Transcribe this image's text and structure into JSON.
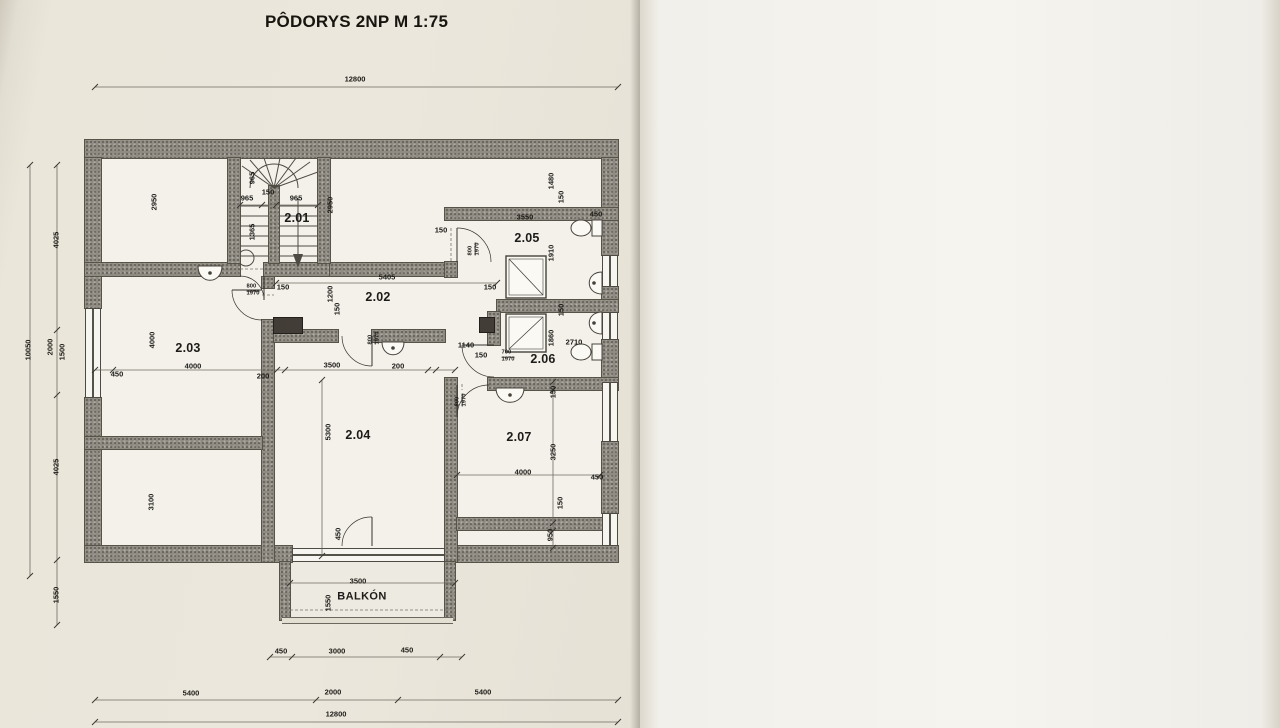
{
  "plan": {
    "title": "PÔDORYS 2NP  M 1:75",
    "labels": [
      {
        "t": "2.01",
        "x": 297,
        "y": 218,
        "c": "room"
      },
      {
        "t": "2.02",
        "x": 378,
        "y": 297,
        "c": "room"
      },
      {
        "t": "2.03",
        "x": 188,
        "y": 348,
        "c": "room"
      },
      {
        "t": "2.04",
        "x": 358,
        "y": 435,
        "c": "room"
      },
      {
        "t": "2.05",
        "x": 527,
        "y": 238,
        "c": "room"
      },
      {
        "t": "2.06",
        "x": 543,
        "y": 359,
        "c": "room"
      },
      {
        "t": "2.07",
        "x": 519,
        "y": 437,
        "c": "room"
      },
      {
        "t": "BALKÓN",
        "x": 362,
        "y": 597,
        "c": "roomname"
      },
      {
        "t": "12800",
        "x": 355,
        "y": 79
      },
      {
        "t": "965",
        "x": 247,
        "y": 198
      },
      {
        "t": "150",
        "x": 268,
        "y": 192
      },
      {
        "t": "965",
        "x": 296,
        "y": 198
      },
      {
        "t": "150",
        "x": 283,
        "y": 287
      },
      {
        "t": "5405",
        "x": 387,
        "y": 277
      },
      {
        "t": "150",
        "x": 441,
        "y": 230
      },
      {
        "t": "3550",
        "x": 525,
        "y": 217
      },
      {
        "t": "450",
        "x": 596,
        "y": 214
      },
      {
        "t": "150",
        "x": 490,
        "y": 287
      },
      {
        "t": "1140",
        "x": 466,
        "y": 345
      },
      {
        "t": "150",
        "x": 481,
        "y": 355
      },
      {
        "t": "2710",
        "x": 574,
        "y": 342
      },
      {
        "t": "450",
        "x": 117,
        "y": 374
      },
      {
        "t": "4000",
        "x": 193,
        "y": 366
      },
      {
        "t": "200",
        "x": 263,
        "y": 376
      },
      {
        "t": "3500",
        "x": 332,
        "y": 365
      },
      {
        "t": "200",
        "x": 398,
        "y": 366
      },
      {
        "t": "4000",
        "x": 523,
        "y": 472
      },
      {
        "t": "450",
        "x": 597,
        "y": 477
      },
      {
        "t": "3500",
        "x": 358,
        "y": 581
      },
      {
        "t": "450",
        "x": 281,
        "y": 651
      },
      {
        "t": "3000",
        "x": 337,
        "y": 651
      },
      {
        "t": "450",
        "x": 407,
        "y": 650
      },
      {
        "t": "5400",
        "x": 191,
        "y": 693
      },
      {
        "t": "2000",
        "x": 333,
        "y": 692
      },
      {
        "t": "5400",
        "x": 483,
        "y": 692
      },
      {
        "t": "12800",
        "x": 336,
        "y": 714
      },
      {
        "t": "10050",
        "x": 28,
        "y": 350,
        "r": 1
      },
      {
        "t": "4025",
        "x": 56,
        "y": 240,
        "r": 1
      },
      {
        "t": "2000",
        "x": 50,
        "y": 347,
        "r": 1
      },
      {
        "t": "1500",
        "x": 62,
        "y": 352,
        "r": 1
      },
      {
        "t": "4025",
        "x": 56,
        "y": 467,
        "r": 1
      },
      {
        "t": "1550",
        "x": 56,
        "y": 595,
        "r": 1
      },
      {
        "t": "2950",
        "x": 154,
        "y": 202,
        "r": 1
      },
      {
        "t": "965",
        "x": 252,
        "y": 178,
        "r": 1
      },
      {
        "t": "1365",
        "x": 252,
        "y": 232,
        "r": 1
      },
      {
        "t": "2950",
        "x": 330,
        "y": 205,
        "r": 1
      },
      {
        "t": "1480",
        "x": 551,
        "y": 181,
        "r": 1
      },
      {
        "t": "150",
        "x": 561,
        "y": 197,
        "r": 1
      },
      {
        "t": "1910",
        "x": 551,
        "y": 253,
        "r": 1
      },
      {
        "t": "150",
        "x": 561,
        "y": 310,
        "r": 1
      },
      {
        "t": "1860",
        "x": 551,
        "y": 338,
        "r": 1
      },
      {
        "t": "1200",
        "x": 330,
        "y": 294,
        "r": 1
      },
      {
        "t": "150",
        "x": 337,
        "y": 309,
        "r": 1
      },
      {
        "t": "4000",
        "x": 152,
        "y": 340,
        "r": 1
      },
      {
        "t": "3100",
        "x": 151,
        "y": 502,
        "r": 1
      },
      {
        "t": "5300",
        "x": 328,
        "y": 432,
        "r": 1
      },
      {
        "t": "450",
        "x": 338,
        "y": 534,
        "r": 1
      },
      {
        "t": "1550",
        "x": 328,
        "y": 603,
        "r": 1
      },
      {
        "t": "150",
        "x": 553,
        "y": 392,
        "r": 1
      },
      {
        "t": "3250",
        "x": 553,
        "y": 452,
        "r": 1
      },
      {
        "t": "150",
        "x": 560,
        "y": 503,
        "r": 1
      },
      {
        "t": "950",
        "x": 550,
        "y": 535,
        "r": 1
      },
      {
        "t": "2900",
        "x": 652,
        "y": 195,
        "r": 1
      },
      {
        "t": "600",
        "t2": "800",
        "x": 652,
        "y": 291,
        "r": 1,
        "c": "door"
      },
      {
        "t": "600",
        "x": 652,
        "y": 312,
        "r": 1
      },
      {
        "t": "600",
        "t2": "800",
        "x": 652,
        "y": 331,
        "r": 1,
        "c": "door"
      },
      {
        "t": "1050",
        "x": 652,
        "y": 356,
        "r": 1
      },
      {
        "t": "10050",
        "x": 677,
        "y": 353,
        "r": 1
      },
      {
        "t": "1400",
        "t2": "800",
        "x": 652,
        "y": 407,
        "r": 1,
        "c": "door"
      },
      {
        "t": "2900",
        "x": 652,
        "y": 497,
        "r": 1
      },
      {
        "t": "800",
        "t2": "1970",
        "x": 253,
        "y": 291,
        "c": "door"
      },
      {
        "t": "800",
        "t2": "1970",
        "x": 475,
        "y": 249,
        "r": 1,
        "c": "door"
      },
      {
        "t": "800",
        "t2": "1970",
        "x": 375,
        "y": 338,
        "r": 1,
        "c": "door"
      },
      {
        "t": "700",
        "t2": "1970",
        "x": 508,
        "y": 357,
        "c": "door"
      },
      {
        "t": "800",
        "t2": "1970",
        "x": 462,
        "y": 400,
        "r": 1,
        "c": "door"
      }
    ]
  },
  "legend": {
    "title": "LEGENDA MIESTNOSTÍ",
    "headers": [
      {
        "t": "Č.M."
      },
      {
        "t": "NÁZOV MIESTNOSTI"
      },
      {
        "t": "PLOCHA",
        "t2": "(m2)"
      },
      {
        "t": "POZNÁMKY"
      }
    ],
    "rows": [
      [
        "2.01",
        "SCHODIŠTE",
        "5,01",
        ""
      ],
      [
        "2.02",
        "CHODBA",
        "8,08",
        ""
      ],
      [
        "2.03",
        "IZBA",
        "15,65",
        ""
      ],
      [
        "2.04",
        "IZBA",
        "18,59",
        ""
      ],
      [
        "2.05",
        "KÚPEĽŇA ŽENY",
        "5,89",
        ""
      ],
      [
        "2.06",
        "KÚPEĽŇA MUŽI",
        "4,77",
        ""
      ],
      [
        "2.07",
        "IZBA",
        "13,00",
        ""
      ]
    ]
  },
  "footer": {
    "note": "DOKUMENTÁCIA SLÚŽI VÝLUČNE PRE POTREBY ZMENY UŽÍVANIA STAVBY !!!",
    "vypracoval_label": "VYPRACOVAL:",
    "vypracoval_value": "ING. ROMAN PAVLÍK",
    "sady_label": "Č. SADY:  1",
    "watermark": "Paint X lite"
  }
}
